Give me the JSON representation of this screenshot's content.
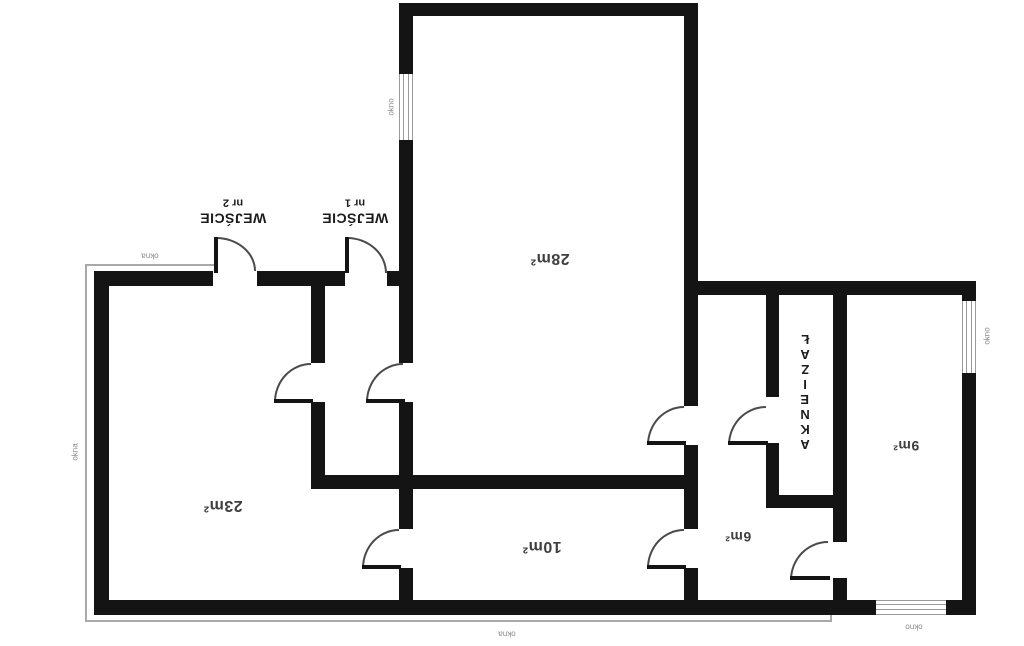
{
  "plan_title": "apartment floor plan",
  "colors": {
    "wall": "#141414",
    "room_label": "#3f3f3f",
    "entrance_label": "#1c1c1c",
    "window_label": "#8a8a8a",
    "thin_window_line": "#a9a9a9",
    "door_arc": "#4a4a4a",
    "background": "#ffffff"
  },
  "rooms": {
    "room28": {
      "area": "28m²"
    },
    "room23": {
      "area": "23m²"
    },
    "room10": {
      "area": "10m²"
    },
    "room6": {
      "area": "6m²"
    },
    "room9": {
      "area": "9m²"
    },
    "bathroom": {
      "name": "ŁAZIENKA"
    }
  },
  "entrances": {
    "e2": {
      "line1": "WEJŚCIE",
      "line2": "nr 2"
    },
    "e1": {
      "line1": "WEJŚCIE",
      "line2": "nr 1"
    }
  },
  "window_labels": {
    "top_left": "okna",
    "left_side": "okna",
    "bottom": "okna",
    "bottom_right": "okno",
    "room28_window": "okno",
    "room9_window": "okno"
  }
}
